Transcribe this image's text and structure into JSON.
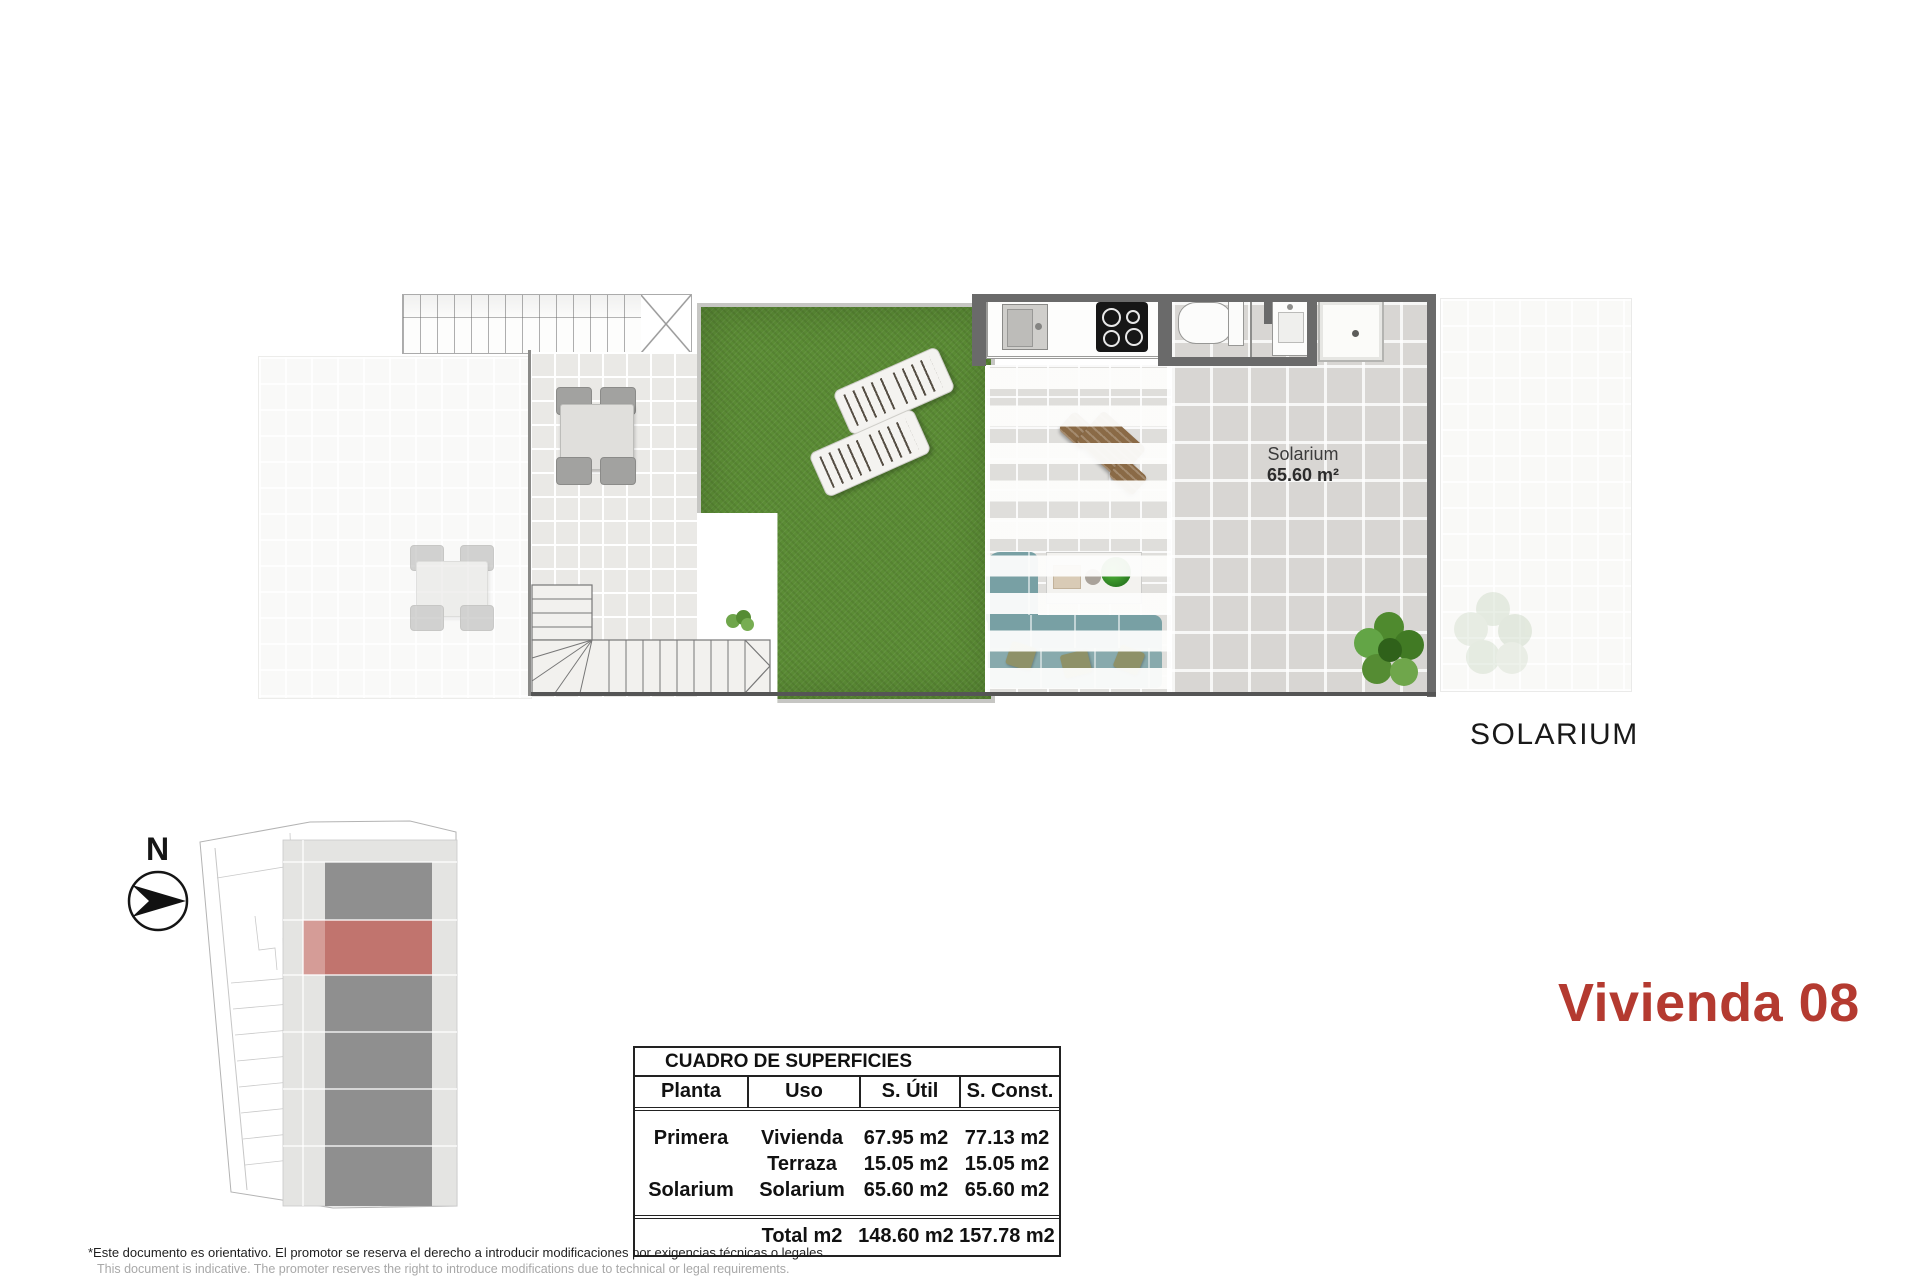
{
  "plan": {
    "solarium_room_label": "Solarium",
    "solarium_room_area": "65.60 m²",
    "caption": "SOLARIUM"
  },
  "compass": {
    "north_label": "N"
  },
  "unit_title": "Vivienda 08",
  "areas_table": {
    "title": "CUADRO DE SUPERFICIES",
    "headers": [
      "Planta",
      "Uso",
      "S. Útil",
      "S. Const."
    ],
    "rows": [
      {
        "planta": "Primera",
        "uso": "Vivienda",
        "util": "67.95 m2",
        "const": "77.13 m2"
      },
      {
        "planta": "",
        "uso": "Terraza",
        "util": "15.05 m2",
        "const": "15.05 m2"
      },
      {
        "planta": "Solarium",
        "uso": "Solarium",
        "util": "65.60 m2",
        "const": "65.60 m2"
      }
    ],
    "total": {
      "label": "Total m2",
      "util": "148.60 m2",
      "const": "157.78 m2"
    }
  },
  "footer": {
    "disclaimer_es": "*Este documento es orientativo. El promotor se reserva el derecho a introducir modificaciones por exigencias técnicas o legales.",
    "disclaimer_en": "This document is indicative. The promoter reserves the right to introduce modifications due to technical or legal requirements."
  },
  "colors": {
    "accent_red": "#b43a30",
    "site_highlight_red": "#c1746e",
    "grass_green": "#5b8c35",
    "wall_gray": "#6a6a6a"
  }
}
